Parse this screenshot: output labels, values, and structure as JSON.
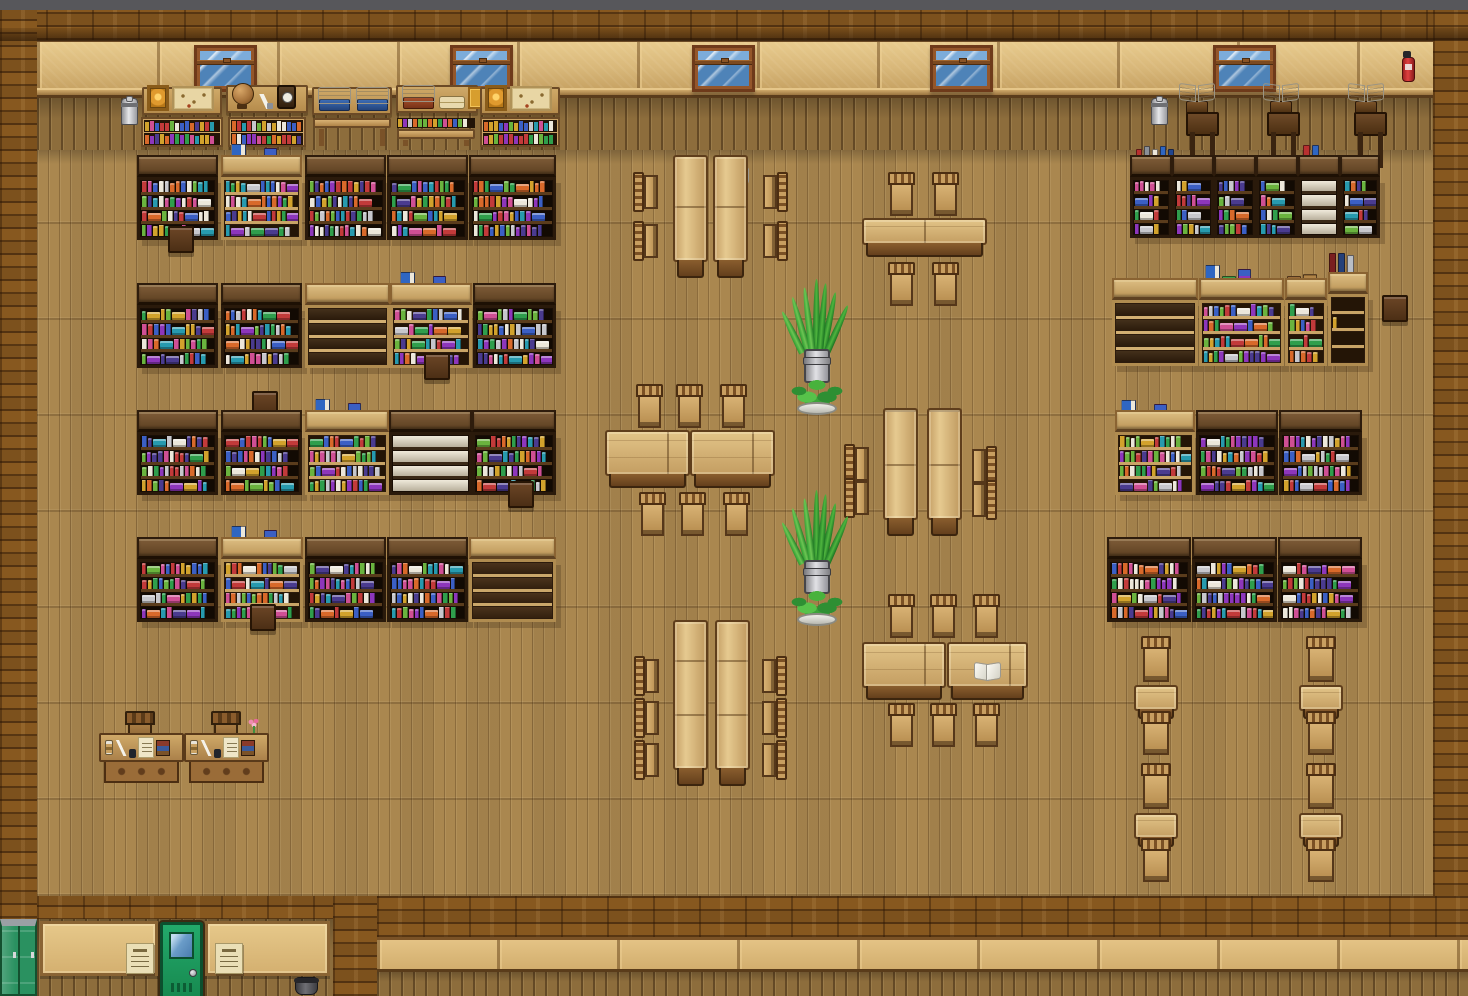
{
  "meta": {
    "scene": "rpg-library-interior-map",
    "style": "top-down pixel-art library with wooden floor"
  },
  "palette": {
    "ui_bar": "#57575b",
    "brick": "#87581f",
    "plaster": "#d9b87a",
    "floor": "#aa874f",
    "shelf_dark_frame": "#2a1a0b",
    "shelf_light_frame": "#b08c50",
    "table_wood": "#d9b87c",
    "door_green": "#1f9e60",
    "locker_green": "#2a9160",
    "window_glass": "#5b94c4",
    "plant_green": "#3da33a",
    "book_spines": [
      "#c23a3a",
      "#3b5fc4",
      "#2f9e4c",
      "#8d36bb",
      "#d2a22c",
      "#279aae",
      "#cf4f94",
      "#d8692a",
      "#ece7da",
      "#6ab33e",
      "#4a3b8f",
      "#c7c7cc"
    ]
  },
  "scene": {
    "windows": [
      [
        194,
        45
      ],
      [
        450,
        45
      ],
      [
        692,
        45
      ],
      [
        930,
        45
      ],
      [
        1213,
        45
      ]
    ],
    "boards": [
      {
        "x": 142,
        "y": 87,
        "w": 80,
        "items": [
          "frame",
          "map"
        ]
      },
      {
        "x": 226,
        "y": 85,
        "w": 82,
        "items": [
          "globe",
          "quill",
          "clock"
        ]
      },
      {
        "x": 312,
        "y": 87,
        "w": 80,
        "items": [
          "bstand_blue",
          "bstand_blue"
        ]
      },
      {
        "x": 396,
        "y": 85,
        "w": 82,
        "items": [
          "bstand_red",
          "scrolls",
          "goldbook"
        ]
      },
      {
        "x": 480,
        "y": 87,
        "w": 80,
        "items": [
          "frame",
          "map"
        ]
      }
    ],
    "lecterns": [
      [
        1178,
        84
      ],
      [
        1262,
        84
      ],
      [
        1347,
        84
      ]
    ],
    "walldesks": [
      [
        1186,
        112
      ],
      [
        1267,
        112
      ],
      [
        1354,
        112
      ]
    ],
    "milk_cans": [
      [
        121,
        98
      ],
      [
        1151,
        98
      ]
    ],
    "extinguishers": [
      [
        1401,
        51
      ]
    ],
    "racks": [
      [
        141,
        117,
        82,
        "books"
      ],
      [
        228,
        117,
        78,
        "books"
      ],
      [
        312,
        117,
        80,
        "bench"
      ],
      [
        396,
        117,
        80,
        "bench_books"
      ],
      [
        480,
        117,
        80,
        "books"
      ]
    ],
    "shelves": [
      [
        137,
        155,
        81,
        85,
        "dark"
      ],
      [
        221,
        155,
        81,
        85,
        "light"
      ],
      [
        305,
        155,
        81,
        85,
        "dark"
      ],
      [
        387,
        155,
        81,
        85,
        "dark"
      ],
      [
        469,
        155,
        87,
        85,
        "dark"
      ],
      [
        137,
        283,
        81,
        85,
        "dark"
      ],
      [
        221,
        283,
        81,
        85,
        "dark"
      ],
      [
        305,
        283,
        85,
        85,
        "light_empty"
      ],
      [
        390,
        283,
        82,
        85,
        "light"
      ],
      [
        473,
        283,
        83,
        85,
        "dark"
      ],
      [
        137,
        410,
        81,
        85,
        "dark"
      ],
      [
        221,
        410,
        81,
        85,
        "dark"
      ],
      [
        305,
        410,
        84,
        85,
        "light"
      ],
      [
        389,
        410,
        83,
        85,
        "white_empty"
      ],
      [
        472,
        410,
        84,
        85,
        "dark"
      ],
      [
        137,
        537,
        81,
        85,
        "dark"
      ],
      [
        221,
        537,
        82,
        85,
        "light"
      ],
      [
        305,
        537,
        81,
        85,
        "dark"
      ],
      [
        387,
        537,
        81,
        85,
        "dark"
      ],
      [
        469,
        537,
        87,
        85,
        "tan_empty"
      ],
      [
        1130,
        155,
        42,
        83,
        "dark_n"
      ],
      [
        1172,
        155,
        42,
        83,
        "dark_n"
      ],
      [
        1214,
        155,
        42,
        83,
        "dark_n"
      ],
      [
        1256,
        155,
        42,
        83,
        "dark_n"
      ],
      [
        1298,
        155,
        42,
        83,
        "white_empty_n"
      ],
      [
        1340,
        155,
        40,
        83,
        "dark_n"
      ],
      [
        1112,
        278,
        86,
        88,
        "light_empty"
      ],
      [
        1199,
        278,
        85,
        88,
        "light"
      ],
      [
        1285,
        278,
        42,
        88,
        "light_n"
      ],
      [
        1328,
        272,
        40,
        94,
        "light_sparse"
      ],
      [
        1115,
        410,
        80,
        85,
        "light"
      ],
      [
        1196,
        410,
        82,
        85,
        "dark"
      ],
      [
        1279,
        410,
        83,
        85,
        "dark"
      ],
      [
        1107,
        537,
        84,
        85,
        "dark"
      ],
      [
        1192,
        537,
        85,
        85,
        "dark"
      ],
      [
        1278,
        537,
        84,
        85,
        "dark"
      ]
    ],
    "deco": [
      [
        231,
        140,
        "a"
      ],
      [
        400,
        268,
        "a"
      ],
      [
        315,
        395,
        "a"
      ],
      [
        231,
        522,
        "a"
      ],
      [
        1136,
        143,
        "b"
      ],
      [
        1303,
        141,
        "c"
      ],
      [
        1205,
        261,
        "a"
      ],
      [
        1287,
        256,
        "stack"
      ],
      [
        1329,
        249,
        "e"
      ],
      [
        1121,
        396,
        "a"
      ],
      [
        722,
        168,
        "openbook"
      ],
      [
        974,
        663,
        "openbook"
      ],
      [
        753,
        431,
        "ink"
      ],
      [
        931,
        398,
        "b_small"
      ]
    ],
    "tables": [
      [
        673,
        155,
        35,
        107,
        "v"
      ],
      [
        713,
        155,
        35,
        107,
        "v"
      ],
      [
        862,
        218,
        125,
        27,
        "h"
      ],
      [
        605,
        430,
        85,
        46,
        "h"
      ],
      [
        690,
        430,
        85,
        46,
        "h"
      ],
      [
        883,
        408,
        35,
        112,
        "v"
      ],
      [
        927,
        408,
        35,
        112,
        "v"
      ],
      [
        673,
        620,
        35,
        150,
        "v"
      ],
      [
        715,
        620,
        35,
        150,
        "v"
      ],
      [
        862,
        642,
        84,
        46,
        "h"
      ],
      [
        947,
        642,
        81,
        46,
        "h"
      ],
      [
        1134,
        685,
        44,
        26,
        "s"
      ],
      [
        1134,
        813,
        44,
        26,
        "s"
      ],
      [
        1299,
        685,
        44,
        26,
        "s"
      ],
      [
        1299,
        813,
        44,
        26,
        "s"
      ]
    ],
    "chairs": [
      [
        633,
        172,
        "right"
      ],
      [
        633,
        221,
        "right"
      ],
      [
        763,
        172,
        "left"
      ],
      [
        763,
        221,
        "left"
      ],
      [
        888,
        172,
        "down"
      ],
      [
        932,
        172,
        "down"
      ],
      [
        888,
        262,
        "up"
      ],
      [
        932,
        262,
        "up"
      ],
      [
        636,
        384,
        "down"
      ],
      [
        676,
        384,
        "down"
      ],
      [
        720,
        384,
        "down"
      ],
      [
        639,
        492,
        "up"
      ],
      [
        679,
        492,
        "up"
      ],
      [
        723,
        492,
        "up"
      ],
      [
        844,
        444,
        "right"
      ],
      [
        844,
        478,
        "right"
      ],
      [
        972,
        446,
        "left"
      ],
      [
        972,
        480,
        "left"
      ],
      [
        634,
        656,
        "right"
      ],
      [
        634,
        698,
        "right"
      ],
      [
        634,
        740,
        "right"
      ],
      [
        762,
        656,
        "left"
      ],
      [
        762,
        698,
        "left"
      ],
      [
        762,
        740,
        "left"
      ],
      [
        888,
        594,
        "down"
      ],
      [
        930,
        594,
        "down"
      ],
      [
        973,
        594,
        "down"
      ],
      [
        888,
        703,
        "up"
      ],
      [
        930,
        703,
        "up"
      ],
      [
        973,
        703,
        "up"
      ],
      [
        1141,
        636,
        "down",
        30,
        46
      ],
      [
        1141,
        711,
        "up",
        30,
        44
      ],
      [
        1141,
        763,
        "down",
        30,
        46
      ],
      [
        1141,
        838,
        "up",
        30,
        44
      ],
      [
        1306,
        636,
        "down",
        30,
        46
      ],
      [
        1306,
        711,
        "up",
        30,
        44
      ],
      [
        1306,
        763,
        "down",
        30,
        46
      ],
      [
        1306,
        838,
        "up",
        30,
        44
      ]
    ],
    "stools": [
      [
        168,
        226
      ],
      [
        252,
        391
      ],
      [
        424,
        353
      ],
      [
        508,
        481
      ],
      [
        250,
        604
      ],
      [
        1382,
        295
      ]
    ],
    "plants": [
      [
        790,
        283
      ],
      [
        790,
        494
      ]
    ],
    "writing_desks": [
      {
        "x": 99,
        "y": 733
      },
      {
        "x": 184,
        "y": 733
      }
    ],
    "desk_chairs": [
      [
        125,
        711
      ],
      [
        211,
        711
      ]
    ],
    "flowers": [
      [
        246,
        719
      ]
    ],
    "lockers": {
      "x": 0,
      "y": 919,
      "w": 37,
      "h": 77
    },
    "door": {
      "x": 160,
      "y": 922,
      "w": 43,
      "h": 74
    },
    "notices": [
      [
        126,
        943
      ],
      [
        215,
        943
      ]
    ],
    "pots": [
      [
        295,
        977
      ]
    ]
  }
}
